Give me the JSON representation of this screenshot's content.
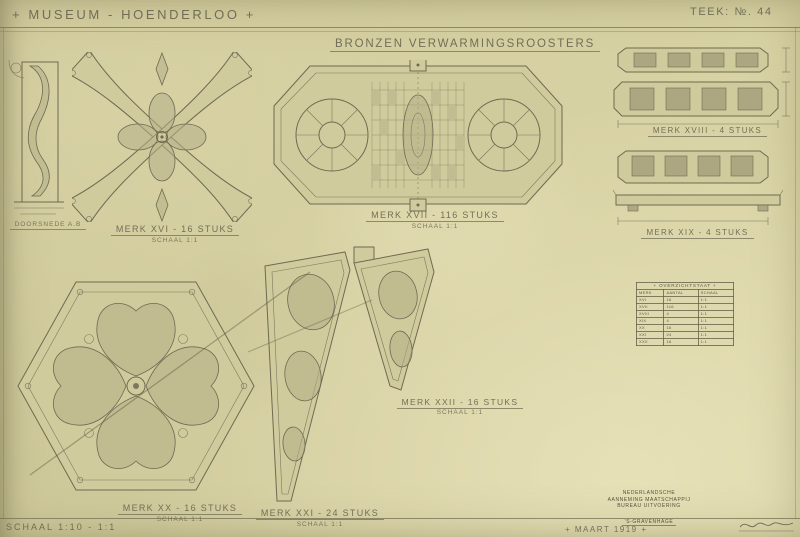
{
  "sheet": {
    "header": {
      "museum_title": "+ MUSEUM - HOENDERLOO +",
      "drawing_no": "TEEK: №. 44"
    },
    "main_title": "BRONZEN VERWARMINGSROOSTERS",
    "drawings": {
      "section": {
        "label": "DOORSNEDE A.B"
      },
      "merk_xvi": {
        "label": "MERK XVI - 16 STUKS",
        "scale": "SCHAAL 1:1"
      },
      "merk_xvii": {
        "label": "MERK XVII - 116 STUKS",
        "scale": "SCHAAL 1:1"
      },
      "merk_xviii": {
        "label": "MERK XVIII - 4 STUKS"
      },
      "merk_xix": {
        "label": "MERK XIX - 4 STUKS"
      },
      "merk_xx": {
        "label": "MERK XX - 16 STUKS",
        "scale": "SCHAAL 1:1"
      },
      "merk_xxi": {
        "label": "MERK XXI - 24 STUKS",
        "scale": "SCHAAL 1:1"
      },
      "merk_xxii": {
        "label": "MERK XXII - 16 STUKS",
        "scale": "SCHAAL 1:1"
      }
    },
    "table": {
      "title": "+ OVERZICHTSTAAT +",
      "headers": [
        "MERK",
        "AANTAL",
        "SCHAAL"
      ],
      "rows": [
        [
          "XVI",
          "16",
          "1:1"
        ],
        [
          "XVII",
          "116",
          "1:1"
        ],
        [
          "XVIII",
          "4",
          "1:1"
        ],
        [
          "XIX",
          "4",
          "1:1"
        ],
        [
          "XX",
          "16",
          "1:1"
        ],
        [
          "XXI",
          "24",
          "1:1"
        ],
        [
          "XXII",
          "16",
          "1:1"
        ]
      ]
    },
    "footer": {
      "scale_note": "SCHAAL 1:10 - 1:1",
      "stamp_lines": [
        "NEDERLANDSCHE",
        "AANNEMING MAATSCHAPPIJ",
        "BUREAU UITVOERING",
        "'S-GRAVENHAGE"
      ],
      "date": "+ MAART 1919 +"
    },
    "colors": {
      "paper": "#d7d2a2",
      "ink": "#6f6a52",
      "shade": "#b8b38c"
    }
  }
}
